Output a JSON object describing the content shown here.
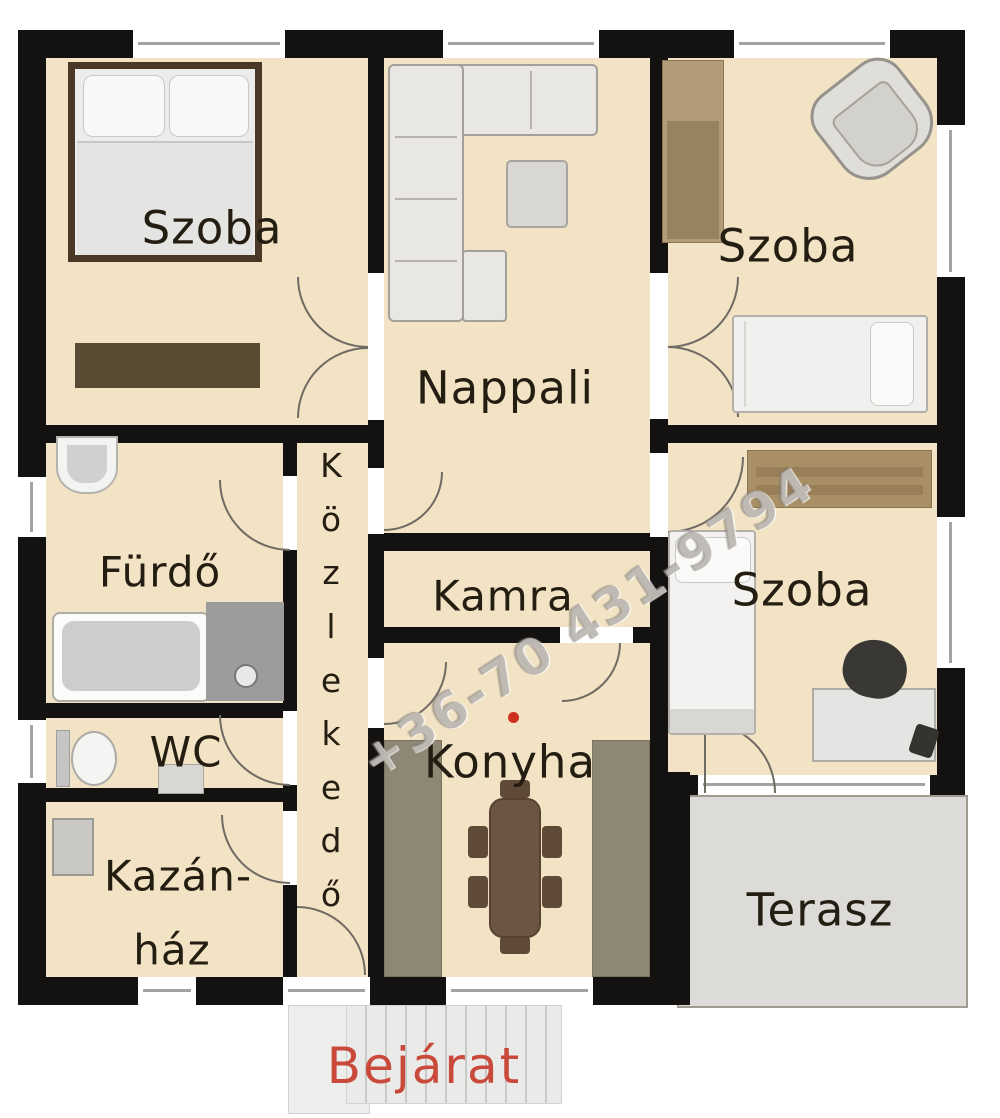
{
  "rooms": {
    "szoba_top_left": {
      "label": "Szoba"
    },
    "nappali": {
      "label": "Nappali"
    },
    "szoba_top_right": {
      "label": "Szoba"
    },
    "furdo": {
      "label": "Fürdő"
    },
    "kozlekedo": {
      "label": "Közlekedő",
      "letters": [
        "K",
        "ö",
        "z",
        "l",
        "e",
        "k",
        "e",
        "d",
        "ő"
      ]
    },
    "kamra": {
      "label": "Kamra"
    },
    "szoba_right": {
      "label": "Szoba"
    },
    "wc": {
      "label": "WC"
    },
    "kazanhaz": {
      "line1": "Kazán-",
      "line2": "ház"
    },
    "konyha": {
      "label": "Konyha"
    },
    "terasz": {
      "label": "Terasz"
    }
  },
  "entrance": {
    "label": "Bejárat"
  },
  "watermark": {
    "text": "+36-70 431-9794"
  },
  "colors": {
    "floor": "#f2e3c4",
    "wall": "#141210",
    "terrace": "#dcdbd8",
    "counter": "#8f8775",
    "wood": "#b29b77",
    "entrance_text": "#c94a3a",
    "red_dot": "#cf2f1f"
  }
}
